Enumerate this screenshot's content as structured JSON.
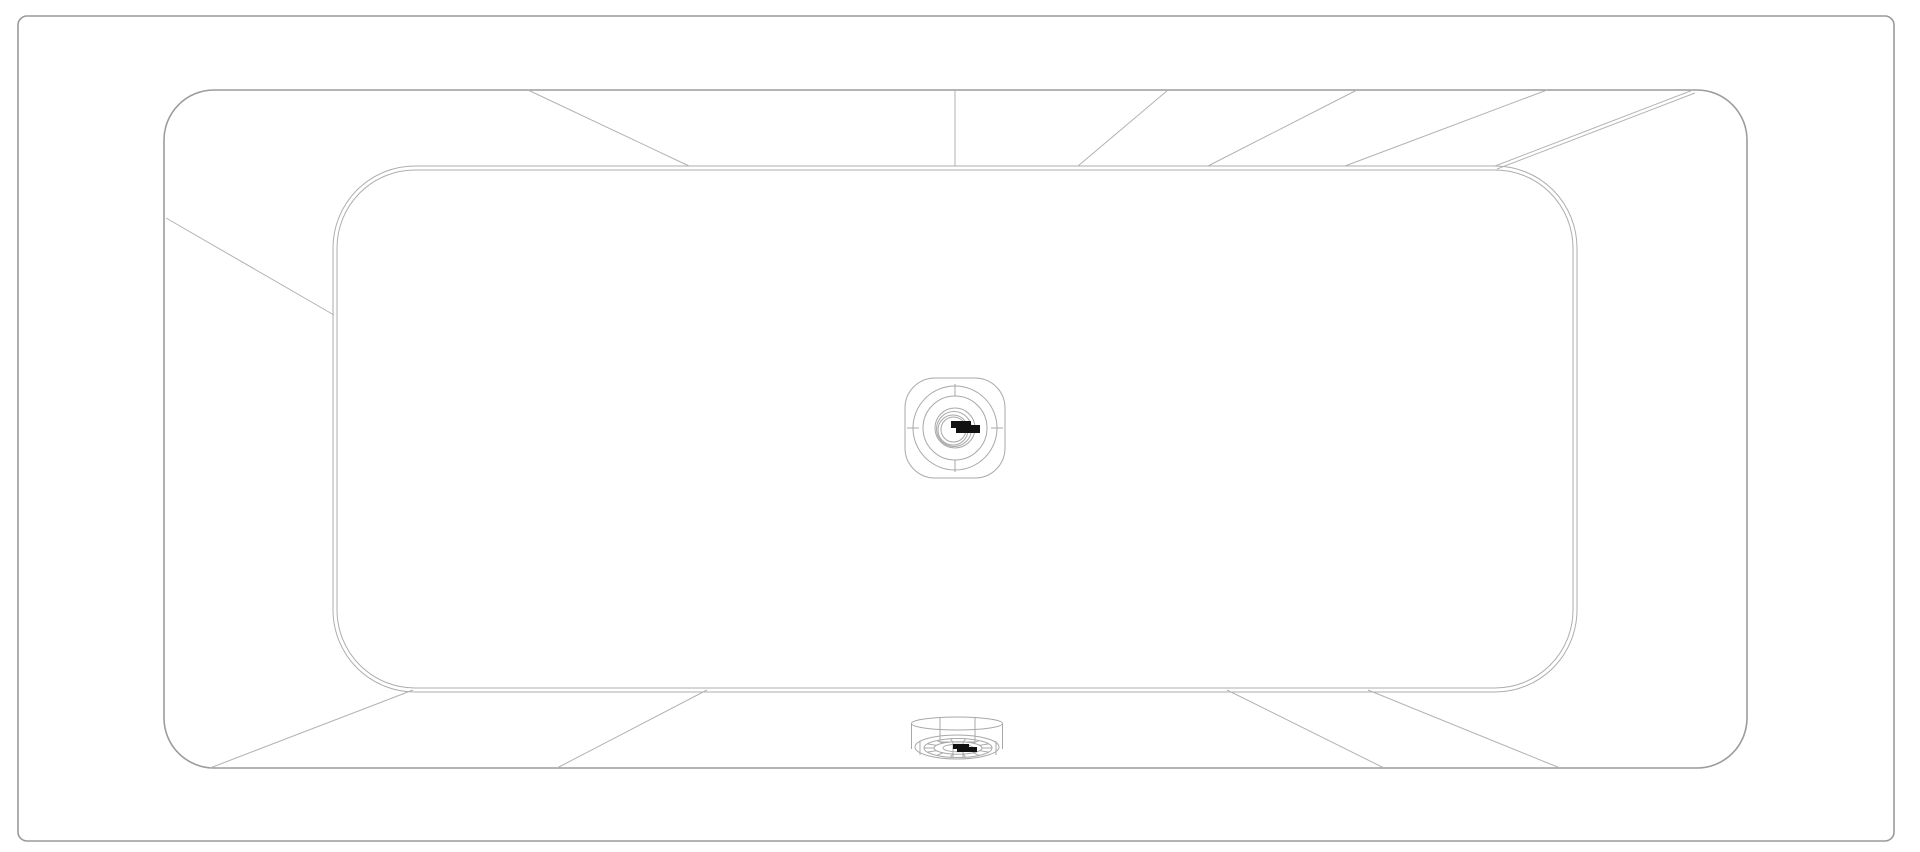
{
  "drawing": {
    "description": "Technical CAD plan view of a rectangular drop-in bathtub with rounded corners, center waste drain and overflow fitting at the bottom edge",
    "background_color": "#ffffff",
    "line_colors": {
      "frame": "#9a9a9a",
      "rim": "#9c9c9c",
      "basin": "#aeaeae",
      "slope": "#b2b2b2",
      "fixture": "#a8a8a8",
      "logo_mark": "#111111"
    },
    "frame": {
      "x": 18,
      "y": 16,
      "w": 1876,
      "h": 825,
      "r": 9,
      "stroke_w": 1.6
    },
    "rim": {
      "x": 164,
      "y": 90,
      "w": 1583,
      "h": 678,
      "r": 50,
      "stroke_w": 1.6
    },
    "basin_outer": {
      "x": 333,
      "y": 166,
      "w": 1244,
      "h": 526,
      "r": 82,
      "stroke_w": 1
    },
    "basin_inner": {
      "x": 337,
      "y": 170,
      "w": 1236,
      "h": 518,
      "r": 78,
      "stroke_w": 1
    },
    "slope_lines": [
      [
        166,
        218,
        334,
        315
      ],
      [
        528,
        90,
        689,
        166
      ],
      [
        955,
        90,
        955,
        166
      ],
      [
        1078,
        166,
        1168,
        90
      ],
      [
        1208,
        166,
        1357,
        90
      ],
      [
        1345,
        166,
        1547,
        90
      ],
      [
        1495,
        166,
        1693,
        90
      ],
      [
        1497,
        169,
        1695,
        93
      ],
      [
        413,
        690,
        210,
        768
      ],
      [
        707,
        690,
        557,
        768
      ],
      [
        1227,
        690,
        1384,
        768
      ],
      [
        1368,
        690,
        1560,
        768
      ]
    ],
    "drain": {
      "cx": 955,
      "cy": 428,
      "squircle": {
        "x": 905,
        "y": 378,
        "w": 100,
        "h": 100,
        "r": 30
      },
      "circles": [
        {
          "r": 42,
          "dx": 0,
          "dy": 0
        },
        {
          "r": 32,
          "dx": 0,
          "dy": 0
        },
        {
          "r": 20,
          "dx": 0,
          "dy": 0
        },
        {
          "r": 17.5,
          "dx": -1,
          "dy": 1
        },
        {
          "r": 15,
          "dx": -2,
          "dy": 2
        },
        {
          "r": 12.5,
          "dx": -1.5,
          "dy": 1.5
        }
      ],
      "ticks": [
        [
          955,
          384,
          955,
          396
        ],
        [
          955,
          460,
          955,
          472
        ],
        [
          907,
          428,
          919,
          428
        ],
        [
          991,
          428,
          1003,
          428
        ]
      ],
      "logo_rects": [
        [
          951,
          421,
          20,
          7
        ],
        [
          956,
          425,
          24,
          8
        ]
      ],
      "logo_note": "illegible manufacturer mark"
    },
    "overflow": {
      "cx": 957,
      "cy": 742,
      "ellipses": [
        {
          "cx": 957,
          "cy": 723.5,
          "rx": 45.5,
          "ry": 6.5
        },
        {
          "cx": 957,
          "cy": 747,
          "rx": 42,
          "ry": 12
        },
        {
          "cx": 958,
          "cy": 748,
          "rx": 34,
          "ry": 9.5
        },
        {
          "cx": 958,
          "cy": 748,
          "rx": 24,
          "ry": 6.2
        },
        {
          "cx": 958,
          "cy": 748,
          "rx": 15,
          "ry": 3.8
        }
      ],
      "lines": [
        [
          911.5,
          723.5,
          911.5,
          749
        ],
        [
          1002.5,
          723.5,
          1002.5,
          749
        ],
        [
          940,
          718,
          940,
          742
        ],
        [
          975,
          718,
          975,
          742
        ],
        [
          940,
          742,
          975,
          742
        ],
        [
          953,
          742,
          953,
          757
        ],
        [
          963,
          742,
          963,
          757
        ],
        [
          920,
          741,
          920,
          755
        ],
        [
          996,
          741,
          996,
          755
        ]
      ],
      "spokes": {
        "cx": 958,
        "cy": 748,
        "rx1": 24,
        "ry1": 6.2,
        "rx2": 34,
        "ry2": 9.5,
        "count": 14
      },
      "logo_rects": [
        [
          953,
          744,
          16,
          5
        ],
        [
          957,
          747,
          20,
          5
        ]
      ],
      "logo_note": "illegible manufacturer mark"
    },
    "canvas": {
      "width": 1920,
      "height": 852
    }
  }
}
